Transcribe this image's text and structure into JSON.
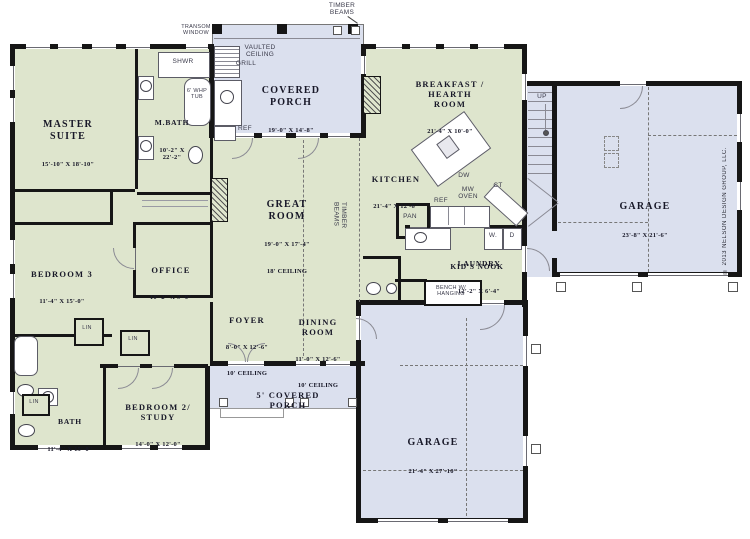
{
  "colors": {
    "interior_fill": "#dee5cd",
    "outdoor_fill": "#dbe0ee",
    "wall": "#161616",
    "label_text": "#181828"
  },
  "copyright": "© 2013 NELSON DESIGN GROUP, LLC.",
  "rooms": {
    "master_suite": {
      "name": "MASTER\nSUITE",
      "dims": "15'-10\" X 18'-10\""
    },
    "m_bath": {
      "name": "M.BATH",
      "dims": "10'-2\" X\n22'-2\""
    },
    "bedroom3": {
      "name": "BEDROOM 3",
      "dims": "11'-4\" X 15'-0\""
    },
    "office": {
      "name": "OFFICE",
      "dims": "10'-2\" X 9'-0\""
    },
    "great_room": {
      "name": "GREAT\nROOM",
      "dims": "19'-0\" X 17'-4\"",
      "ceiling": "18' CEILING"
    },
    "foyer": {
      "name": "FOYER",
      "dims": "8'-0\" X 12'-6\"",
      "ceiling": "10' CEILING"
    },
    "dining_room": {
      "name": "DINING\nROOM",
      "dims": "11'-0\" X 12'-6\"",
      "ceiling": "10' CEILING"
    },
    "kitchen": {
      "name": "KITCHEN",
      "dims": "21'-4\" X 12'-6\""
    },
    "breakfast": {
      "name": "BREAKFAST /\nHEARTH\nROOM",
      "dims": "21'-4\" X 10'-0\""
    },
    "laundry": {
      "name": "LAUNDRY",
      "dims": "12'-2\" X 6'-4\""
    },
    "bath": {
      "name": "BATH",
      "dims": "11'-4\" X 15'-0\""
    },
    "bedroom2": {
      "name": "BEDROOM 2/\nSTUDY",
      "dims": "14'-0\" X 12'-0\""
    },
    "covered_porch": {
      "name": "COVERED\nPORCH",
      "dims": "19'-0\" X 14'-8\""
    },
    "porch5": {
      "name": "5' COVERED\nPORCH"
    },
    "garage_side": {
      "name": "GARAGE",
      "dims": "23'-8\" X 21'-6\""
    },
    "garage_rear": {
      "name": "GARAGE",
      "dims": "21'-4\" X 27'-10\""
    }
  },
  "notes": {
    "timber_beams": "TIMBER\nBEAMS",
    "transom_window": "TRANSOM\nWINDOW",
    "vaulted_ceiling": "VAULTED\nCEILING",
    "grill": "GRILL",
    "ref": "REF",
    "shwr": "SHWR",
    "whp_tub": "6' WHP\nTUB",
    "up": "UP",
    "pan": "PAN",
    "dw": "DW",
    "mw_oven": "MW\nOVEN",
    "ct": "CT",
    "washer": "W.",
    "dryer": "D",
    "kids_nook": "KID'S NOOK",
    "bench": "BENCH W/\nHANGING",
    "lin": "LIN"
  }
}
